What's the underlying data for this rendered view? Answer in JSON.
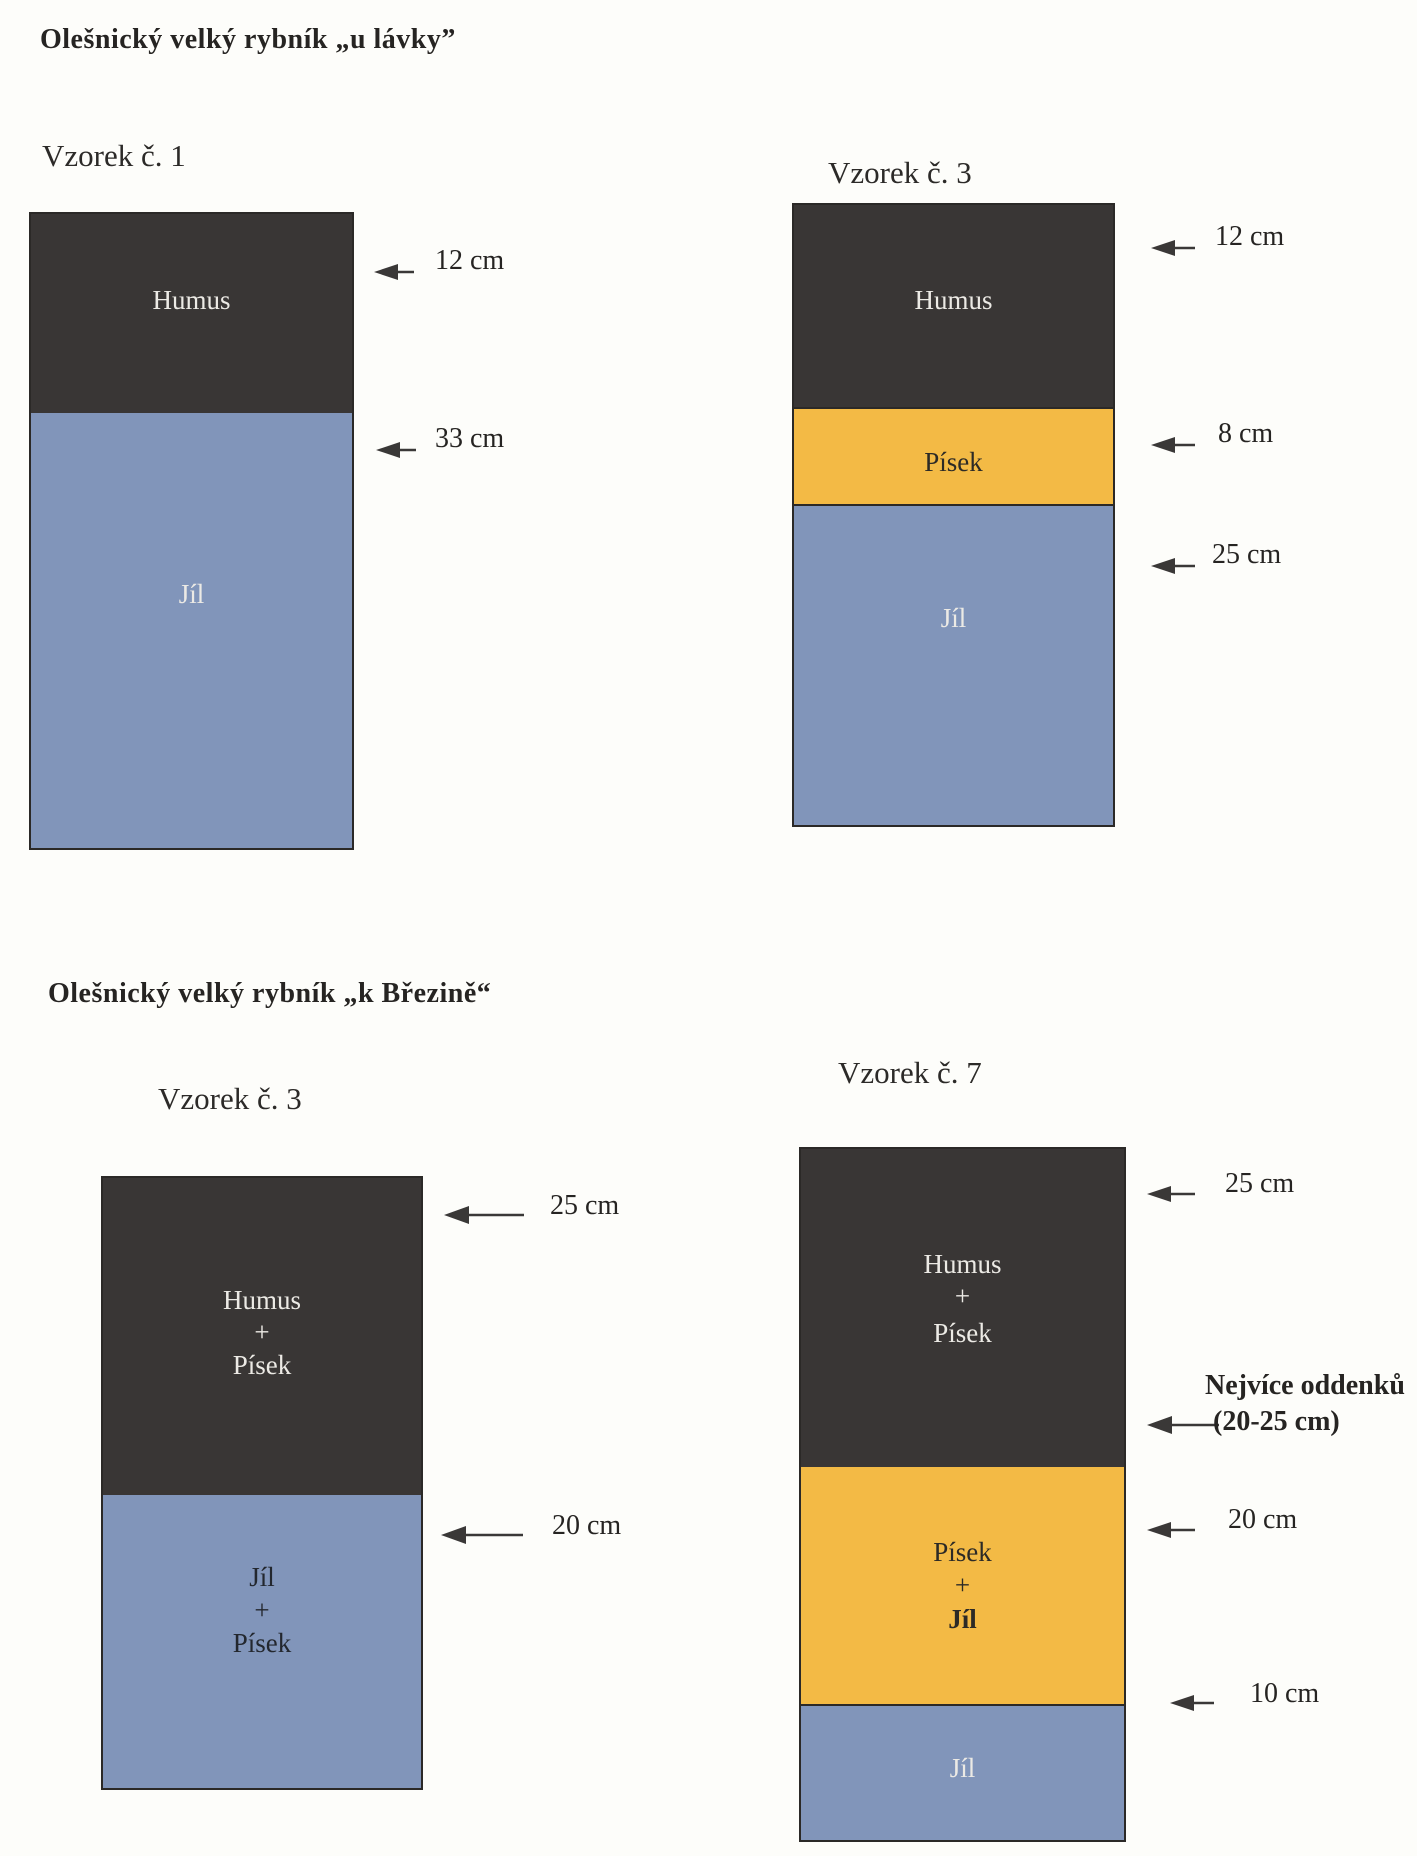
{
  "document": {
    "kind": "soil profile diagrams (scanned page)",
    "colors": {
      "humus": "#393635",
      "pisek": "#f3ba45",
      "jil": "#8195ba",
      "paper": "#fdfdfa",
      "ink": "#2a2826"
    },
    "sections": [
      {
        "title": "Olešnický velký rybník „u lávky”",
        "diagrams": [
          {
            "title": "Vzorek č. 1",
            "layers": [
              {
                "material": "Humus",
                "labels": [
                  "Humus"
                ]
              },
              {
                "material": "Jíl",
                "labels": [
                  "Jíl"
                ]
              }
            ],
            "annotations": [
              {
                "label": "12 cm"
              },
              {
                "label": "33 cm"
              }
            ]
          },
          {
            "title": "Vzorek č. 3",
            "layers": [
              {
                "material": "Humus",
                "labels": [
                  "Humus"
                ]
              },
              {
                "material": "Písek",
                "labels": [
                  "Písek"
                ]
              },
              {
                "material": "Jíl",
                "labels": [
                  "Jíl"
                ]
              }
            ],
            "annotations": [
              {
                "label": "12 cm"
              },
              {
                "label": "8 cm"
              },
              {
                "label": "25 cm"
              }
            ]
          }
        ]
      },
      {
        "title": "Olešnický velký rybník „k Březině“",
        "diagrams": [
          {
            "title": "Vzorek č. 3",
            "layers": [
              {
                "material": "Humus + Písek",
                "labels": [
                  "Humus",
                  "+",
                  "Písek"
                ]
              },
              {
                "material": "Jíl + Písek",
                "labels": [
                  "Jíl",
                  "+",
                  "Písek"
                ]
              }
            ],
            "annotations": [
              {
                "label": "25 cm"
              },
              {
                "label": "20 cm"
              }
            ]
          },
          {
            "title": "Vzorek č. 7",
            "layers": [
              {
                "material": "Humus + Písek",
                "labels": [
                  "Humus",
                  "+",
                  "Písek"
                ]
              },
              {
                "material": "Písek + Jíl",
                "labels": [
                  "Písek",
                  "+",
                  "Jíl"
                ]
              },
              {
                "material": "Jíl",
                "labels": [
                  "Jíl"
                ]
              }
            ],
            "annotations": [
              {
                "label": "25 cm"
              },
              {
                "label": "Nejvíce oddenků",
                "label2": "(20-25 cm)"
              },
              {
                "label": "20 cm"
              },
              {
                "label": "10 cm"
              }
            ]
          }
        ]
      }
    ]
  }
}
